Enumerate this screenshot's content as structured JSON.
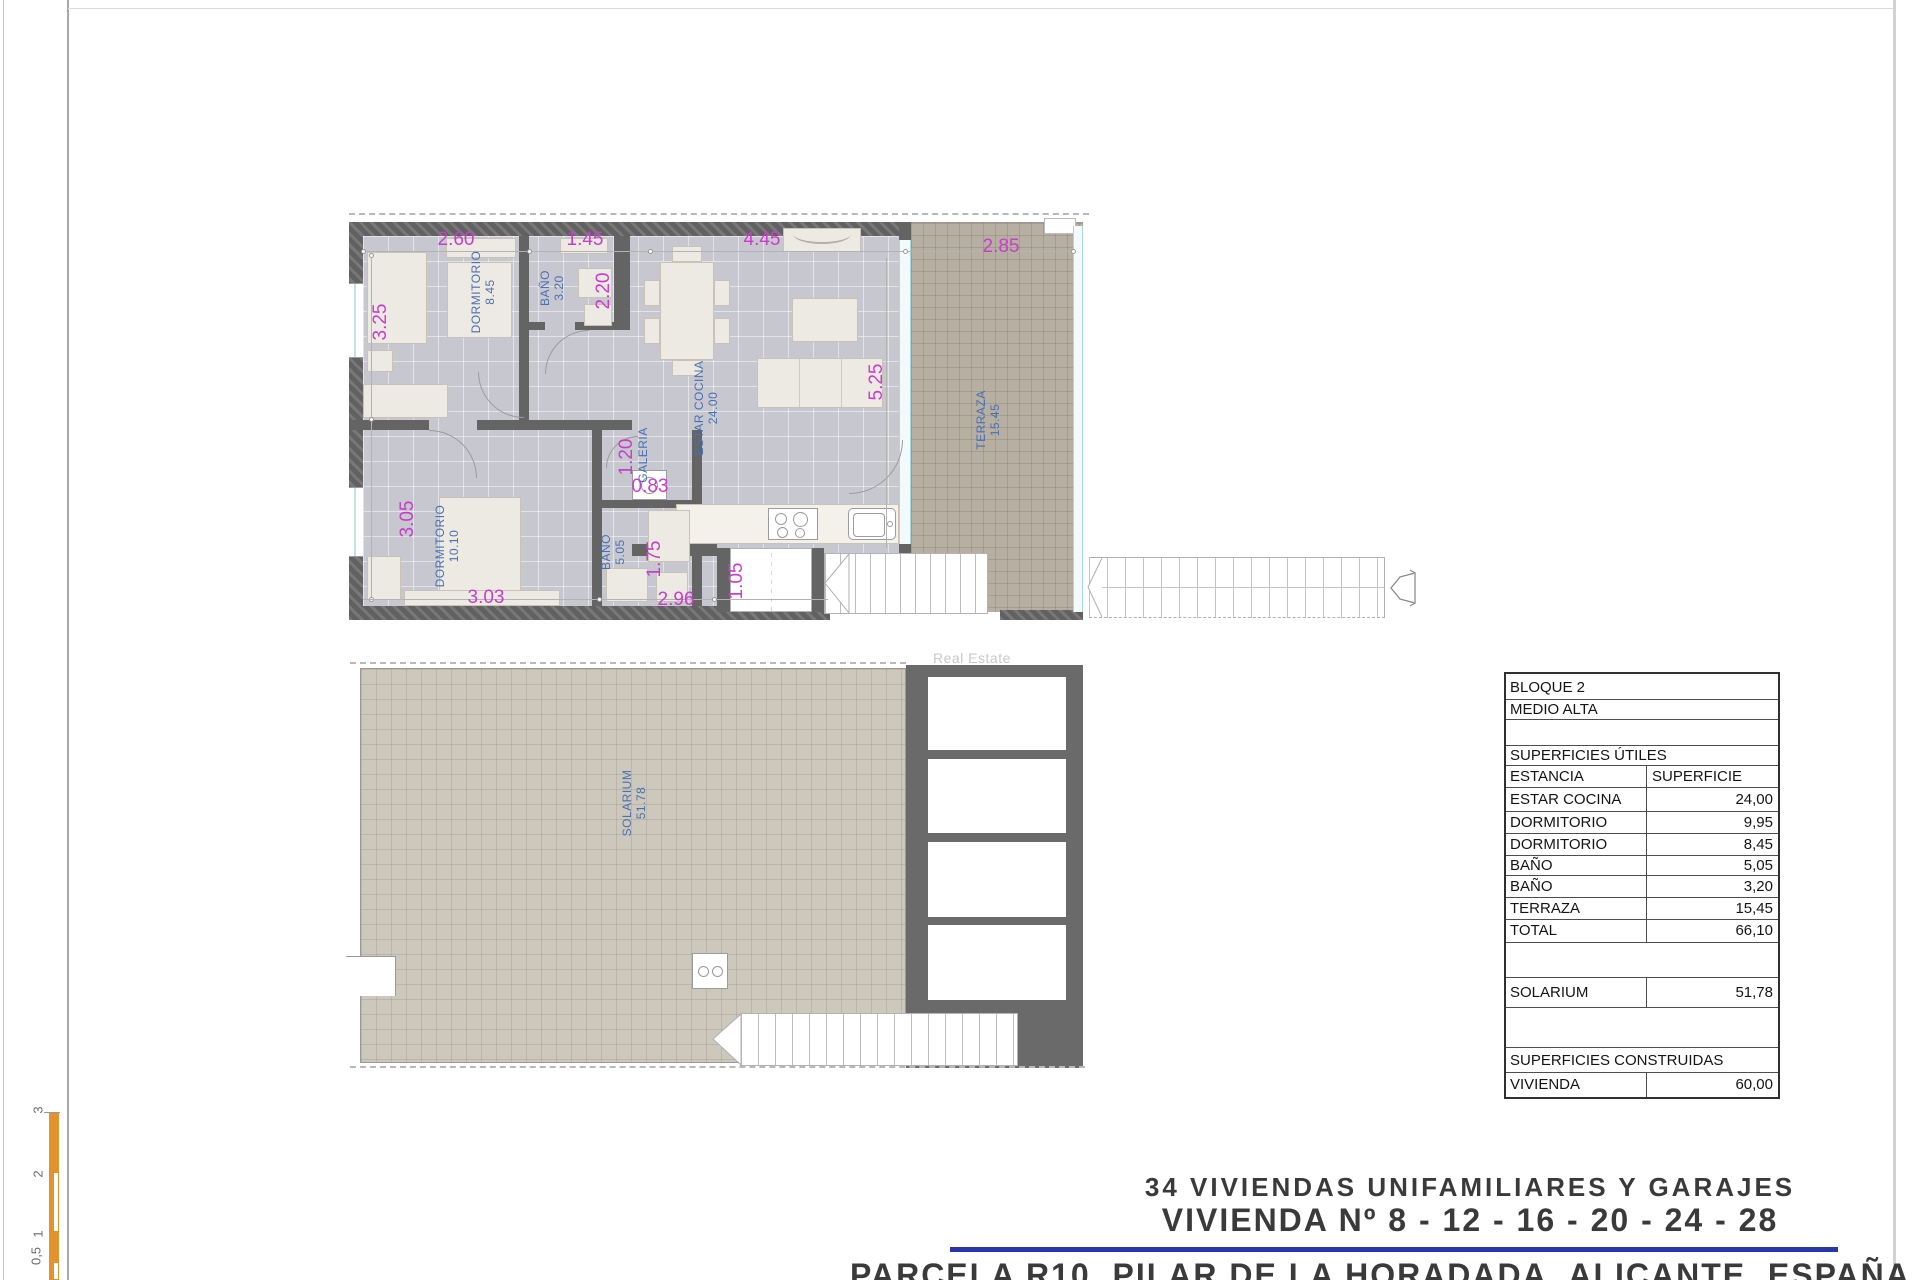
{
  "sheet": {
    "watermark": "Real Estate",
    "scale_bar_labels": [
      "3",
      "2",
      "1",
      "0,5"
    ],
    "colors": {
      "dimension_text": "#c93ec9",
      "room_label_text": "#4a6fb0",
      "scale_bar": "#e2932d",
      "accent_rule": "#2a35a8",
      "wall": "#646464"
    }
  },
  "plan_upper": {
    "rooms": {
      "dorm1": {
        "name": "DORMITORIO",
        "area": "8.45"
      },
      "bath1": {
        "name": "BAÑO",
        "area": "3.20"
      },
      "living": {
        "name": "ESTAR COCINA",
        "area": "24.00"
      },
      "galeria": {
        "name": "GALERIA",
        "area": ""
      },
      "dorm2": {
        "name": "DORMITORIO",
        "area": "10.10"
      },
      "bath2": {
        "name": "BAÑO",
        "area": "5.05"
      },
      "terrace": {
        "name": "TERRAZA",
        "area": "15.45"
      }
    },
    "dims": {
      "top1": "2.60",
      "top2": "1.45",
      "top3": "4.45",
      "top4": "2.85",
      "left1": "3.25",
      "left2": "3.05",
      "v_bath1": "2.20",
      "v_living": "5.25",
      "v_galeria": "1.20",
      "v_bath2": "1.75",
      "v_closet": "1.05",
      "h_galeria": "0.83",
      "bottom1": "3.03",
      "bottom2": "2.96"
    }
  },
  "plan_lower": {
    "room": {
      "name": "SOLARIUM",
      "area": "51.78"
    }
  },
  "area_table": {
    "block": "BLOQUE 2",
    "level": "MEDIO ALTA",
    "section_utiles": "SUPERFICIES ÚTILES",
    "col_estancia": "ESTANCIA",
    "col_superficie": "SUPERFICIE",
    "rows": [
      {
        "label": "ESTAR COCINA",
        "value": "24,00"
      },
      {
        "label": "DORMITORIO",
        "value": "9,95"
      },
      {
        "label": "DORMITORIO",
        "value": "8,45"
      },
      {
        "label": "BAÑO",
        "value": "5,05"
      },
      {
        "label": "BAÑO",
        "value": "3,20"
      },
      {
        "label": "TERRAZA",
        "value": "15,45"
      },
      {
        "label": "TOTAL",
        "value": "66,10"
      }
    ],
    "solarium": {
      "label": "SOLARIUM",
      "value": "51,78"
    },
    "section_construidas": "SUPERFICIES CONSTRUIDAS",
    "vivienda": {
      "label": "VIVIENDA",
      "value": "60,00"
    }
  },
  "title_block": {
    "line1": "34 VIVIENDAS UNIFAMILIARES Y GARAJES",
    "line2": "VIVIENDA Nº 8 - 12 - 16 - 20 - 24 - 28",
    "line3": "PARCELA R10, PILAR DE LA HORADADA, ALICANTE, ESPAÑA"
  }
}
